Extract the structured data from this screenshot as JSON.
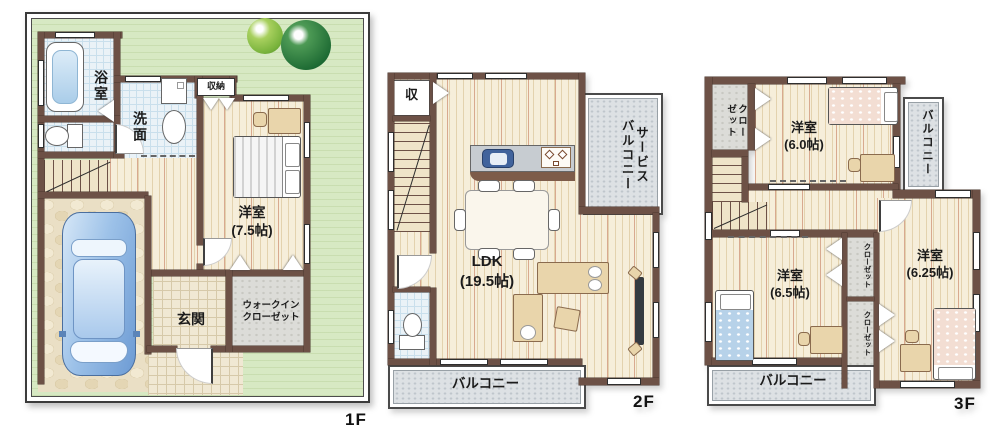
{
  "colors": {
    "wall": "#6d5146",
    "wall_dark": "#4a372e",
    "floor": "#f6eeda",
    "floor_stripe": "#e3d2ae",
    "floor_stripe_red": "#d8a98f",
    "lawn": "#d7e9c3",
    "bath_floor": "#eaf2f7",
    "bath_grid": "#c9dfec",
    "tile": "#f0e8d3",
    "tile_grid": "#d6c9a9",
    "stone": "#eadfc5",
    "gray_zone": "#dde1e4",
    "gray_dot": "#bfc6cc",
    "text": "#1b1b1b",
    "furniture": "#e9d5ab",
    "furniture_border": "#8a6b4e",
    "counter": "#c7ccd1",
    "sink": "#41639c",
    "car_body": "#9fc3e8",
    "tree_dark": "#1d6a33",
    "tree_light": "#79b33c",
    "bed_pink": "#f3ded3",
    "bed_blue": "#b7d2e9"
  },
  "floor1": {
    "label": "1F",
    "bath": "浴室",
    "washroom": "洗面",
    "storage": "収納",
    "bedroom": "洋室\n(7.5帖)",
    "entrance": "玄関",
    "walk_in_closet": "ウォークイン\nクローゼット"
  },
  "floor2": {
    "label": "2F",
    "storage": "収",
    "service_balcony": "サービス\nバルコニー",
    "ldk": "LDK\n(19.5帖)",
    "balcony": "バルコニー"
  },
  "floor3": {
    "label": "3F",
    "closet_nw": "クロー\nゼット",
    "bedroom_a": "洋室\n(6.0帖)",
    "balcony_east": "バルコニー",
    "bedroom_b": "洋室\n(6.5帖)",
    "closet_mid_upper": "クローゼット",
    "closet_mid_lower": "クローゼット",
    "bedroom_c": "洋室\n(6.25帖)",
    "balcony_south": "バルコニー"
  }
}
